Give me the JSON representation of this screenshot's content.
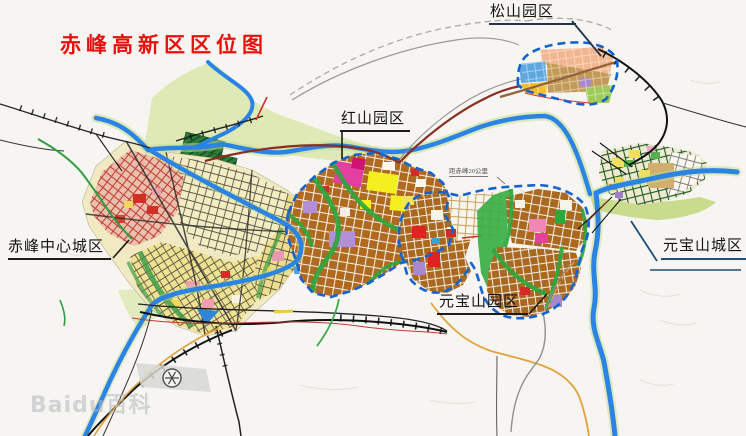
{
  "page": {
    "width": 746,
    "height": 436,
    "background": "#f6f5f1"
  },
  "title": {
    "text": "赤峰高新区区位图",
    "color": "#e8100d"
  },
  "labels": {
    "songshan_park": {
      "text": "松山园区"
    },
    "hongshan_park": {
      "text": "红山园区"
    },
    "chifeng_central_city": {
      "text": "赤峰中心城区"
    },
    "yuanbaoshan_park": {
      "text": "元宝山园区"
    },
    "yuanbaoshan_city": {
      "text": "元宝山城区"
    },
    "distance_note": {
      "text": "距赤峰20公里"
    }
  },
  "watermark": {
    "text": "Baidu百科"
  },
  "map": {
    "regions": [
      {
        "name": "松山园区",
        "type": "园区",
        "boundary_color": "#1463cf",
        "boundary_style": "dashed"
      },
      {
        "name": "红山园区",
        "type": "园区",
        "boundary_color": "#1463cf",
        "boundary_style": "dashed"
      },
      {
        "name": "元宝山园区",
        "type": "园区",
        "boundary_color": "#1463cf",
        "boundary_style": "dashed"
      },
      {
        "name": "赤峰中心城区",
        "type": "城区"
      },
      {
        "name": "元宝山城区",
        "type": "城区"
      }
    ],
    "palette": {
      "river": "#2b84e4",
      "region_border": "#1463cf",
      "industrial_block": "#b06a1f",
      "farmland": "#dde8b2",
      "park_green": "#2ca83c",
      "road_rail": "#111111",
      "highway_maroon": "#8a2f22",
      "label_line": "#1f4e79",
      "title_red": "#e8100d"
    }
  }
}
